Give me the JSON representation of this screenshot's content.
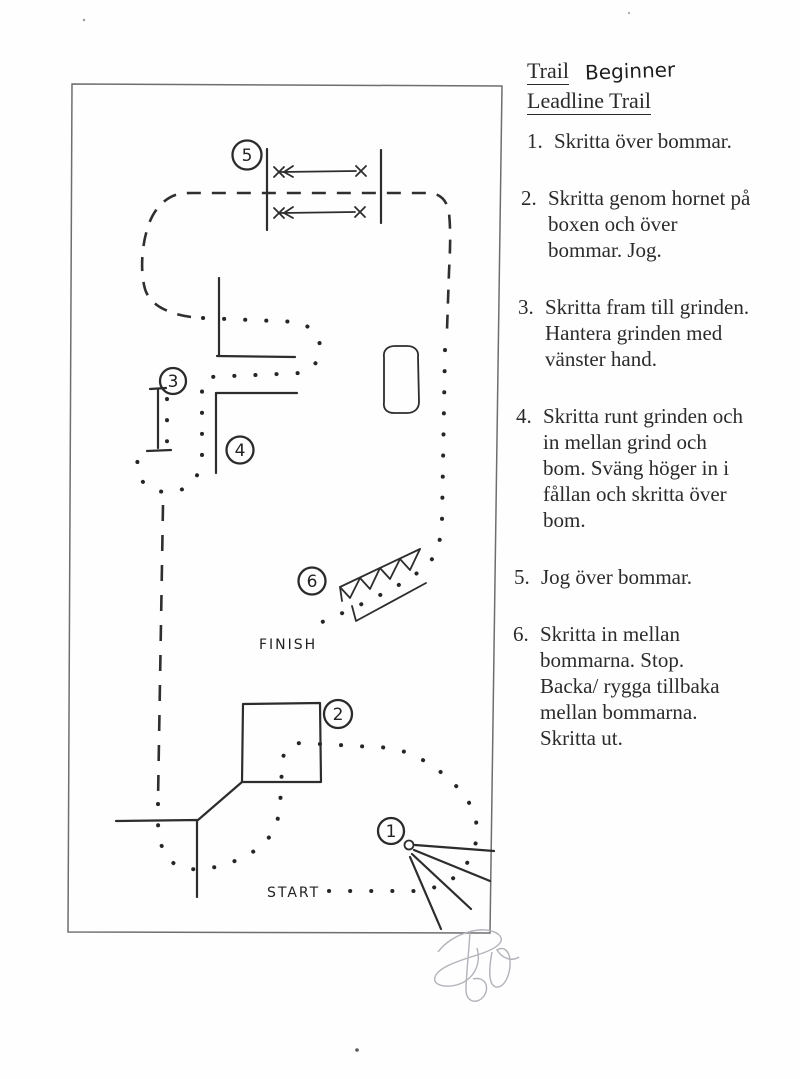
{
  "doc": {
    "title": "Trail",
    "title_annotation": "Beginner",
    "subtitle": "Leadline Trail",
    "instructions": [
      {
        "num": "1.",
        "lines": [
          "Skritta över bommar."
        ]
      },
      {
        "num": "2.",
        "lines": [
          "Skritta genom hornet på",
          "boxen och över",
          "bommar. Jog."
        ]
      },
      {
        "num": "3.",
        "lines": [
          "Skritta fram till grinden.",
          "Hantera grinden med",
          "vänster hand."
        ]
      },
      {
        "num": "4.",
        "lines": [
          "Skritta runt grinden och",
          "in mellan grind och",
          "bom. Sväng höger in i",
          "fållan och skritta över",
          "bom."
        ]
      },
      {
        "num": "5.",
        "lines": [
          "Jog över bommar."
        ]
      },
      {
        "num": "6.",
        "lines": [
          "Skritta in mellan",
          "bommarna. Stop.",
          "Backa/ rygga tillbaka",
          "mellan bommarna.",
          "Skritta ut."
        ]
      }
    ]
  },
  "diagram": {
    "start_label": "START",
    "finish_label": "FINISH",
    "marker_labels": [
      "1",
      "2",
      "3",
      "4",
      "5",
      "6"
    ],
    "ink_color": "#2d2d2d",
    "paper_color": "#fefefe"
  }
}
